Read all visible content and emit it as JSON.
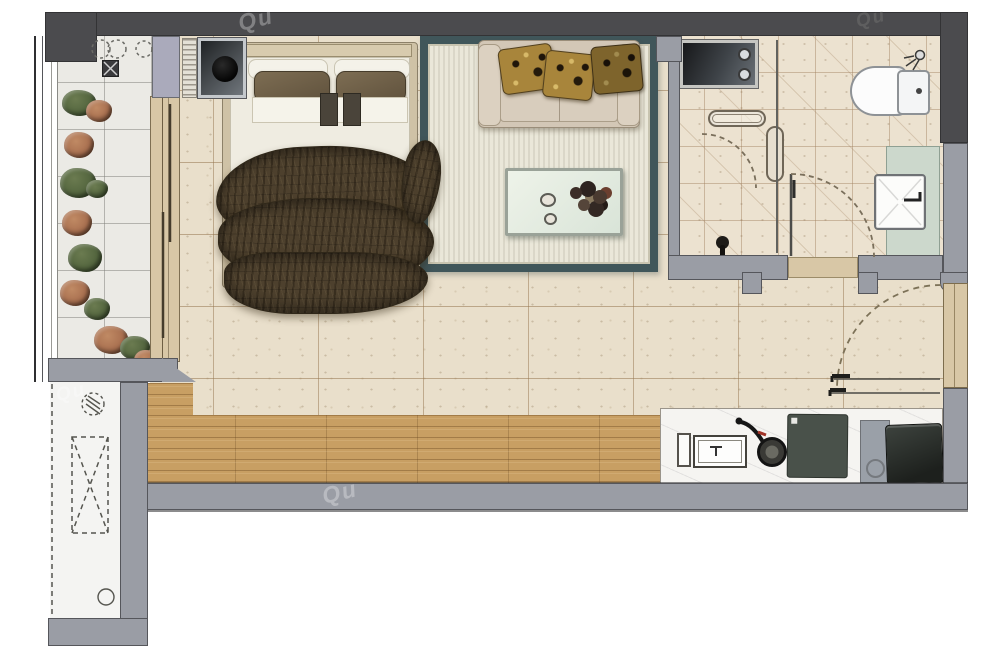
{
  "meta": {
    "title": "studio-apartment-floor-plan",
    "view": "top-down rendered architectural plan",
    "width_px": 1000,
    "height_px": 666
  },
  "watermark": {
    "text": "Qu"
  },
  "palette": {
    "wall_dark": "#4b4b4e",
    "wall_light": "#9a9da5",
    "tile_main": "#e9dfcb",
    "tile_grout": "#b29a78",
    "tile_bath": "#ece2d0",
    "tile_balcony": "#ebeae5",
    "wood_floor": "#c89f63",
    "counter_marble": "#f5f4f1",
    "rug_border": "#40565a",
    "rug_field": "#eae7d9",
    "sofa": "#d3c7b6",
    "pillow_gold": "#a8853b",
    "bed_frame": "#cfc2a6",
    "duvet_brown": "#4d402d",
    "vanity_counter": "#ccd8cc",
    "appliance_dark": "#49514a",
    "fridge": "#2d322e",
    "door_leaf": "#d8c7a6",
    "plant_green": "#54663f",
    "plant_rust": "#a97050"
  },
  "rooms": [
    {
      "id": "balcony",
      "fixtures": [
        "window-wall",
        "planter-shrubs",
        "floor-drain",
        "dashed-circle-symbols"
      ]
    },
    {
      "id": "bedroom-living",
      "fixtures": [
        "double-bed",
        "headboard",
        "pillows",
        "duvet",
        "bedside-cabinet-with-lamp",
        "radiator-hatch",
        "sliding-door",
        "area-rug",
        "two-seat-sofa",
        "throw-pillows",
        "coffee-table",
        "flower-arrangement"
      ]
    },
    {
      "id": "bathroom",
      "fixtures": [
        "washing-machine",
        "towel-rail",
        "water-heater",
        "glass-partition",
        "shower-door-swing",
        "bathroom-door-swing",
        "toilet",
        "shower-head",
        "vanity-counter",
        "wash-basin",
        "floor-brush"
      ]
    },
    {
      "id": "kitchen",
      "fixtures": [
        "marble-counter",
        "kitchen-sink",
        "frying-pan",
        "cooktop-slab",
        "refrigerator"
      ]
    },
    {
      "id": "entry",
      "fixtures": [
        "entry-door-leaf",
        "door-swing-arc",
        "threshold-lines",
        "wood-floor"
      ]
    },
    {
      "id": "utility-shaft",
      "fixtures": [
        "dashed-duct-cross",
        "hatched-drain-circle",
        "pipe-circle"
      ]
    }
  ]
}
